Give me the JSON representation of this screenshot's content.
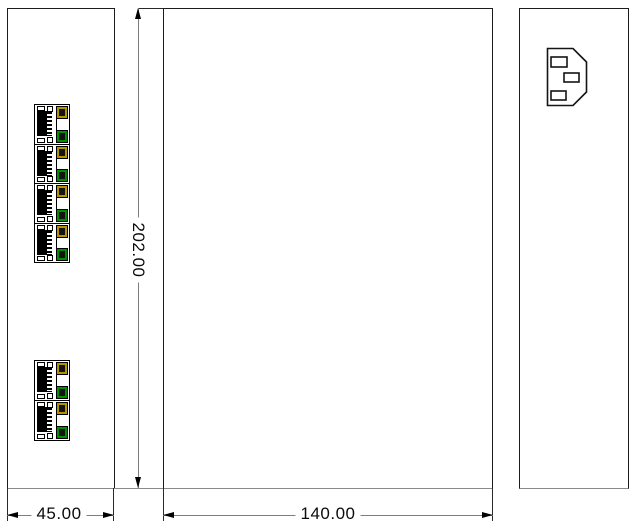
{
  "drawing": {
    "type": "three-view-technical-drawing",
    "dimensions": {
      "left_view_width": {
        "value": "45.00"
      },
      "height": {
        "value": "202.00"
      },
      "front_view_width": {
        "value": "140.00"
      }
    },
    "left_view": {
      "port_type": "rj45-ethernet-port",
      "port_groups": [
        {
          "name": "upper-port-group",
          "port_count": 4
        },
        {
          "name": "lower-port-group",
          "port_count": 2
        }
      ]
    },
    "right_view": {
      "connector": "iec-c14-power-inlet"
    },
    "colors": {
      "line": "#1c1c1c",
      "dimension_line": "#7d7d7d",
      "led_top": "#b49400",
      "led_bottom": "#008f00"
    }
  }
}
